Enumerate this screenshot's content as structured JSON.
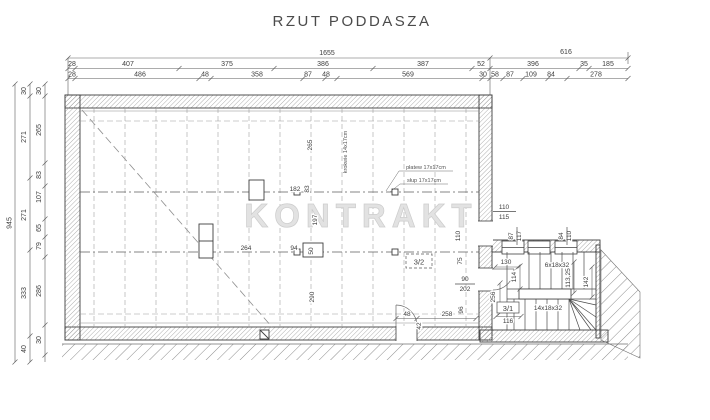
{
  "title": "RZUT PODDASZA",
  "watermark": "KONTRAKT",
  "dims": {
    "top_row1": [
      "1655",
      "616"
    ],
    "top_row2": [
      "28",
      "407",
      "375",
      "386",
      "387",
      "52",
      "396",
      "35",
      "185"
    ],
    "top_row3": [
      "28",
      "486",
      "48",
      "358",
      "87",
      "48",
      "569",
      "30",
      "58",
      "87",
      "109",
      "84",
      "278"
    ],
    "left_col1": [
      "945"
    ],
    "left_col2": [
      "30",
      "271",
      "271",
      "333",
      "40"
    ],
    "left_col3": [
      "30",
      "265",
      "83",
      "107",
      "65",
      "79",
      "286",
      "30"
    ]
  },
  "plan": {
    "rooms": {
      "r32": "3/2",
      "r31": "3/1"
    },
    "labels": {
      "rafters": "krokwie 14x17cm",
      "purlin": "płatew 17x17cm",
      "post": "słup 17x17cm"
    },
    "stairs": {
      "upper": "6x18x32",
      "lower": "14x18x32"
    },
    "inner": {
      "d264": "264",
      "d94": "94",
      "d50": "50",
      "d290": "290",
      "d182": "182",
      "d83": "83",
      "d197": "197",
      "d265": "265",
      "d110_over": "110",
      "d115_under": "115",
      "d110_left": "110",
      "d87": "87",
      "d117": "117",
      "d84": "84",
      "d110_right": "110",
      "d75": "75",
      "d90": "90",
      "d202": "202",
      "d96": "96",
      "d48": "48",
      "d42": "42",
      "d258": "258",
      "d130": "130",
      "d114": "114",
      "d256": "256",
      "d116": "116",
      "d113": "113,25",
      "d142": "142"
    }
  },
  "colors": {
    "line": "#444444",
    "text": "#3d3d3d",
    "watermark": "#e2e2e2"
  }
}
